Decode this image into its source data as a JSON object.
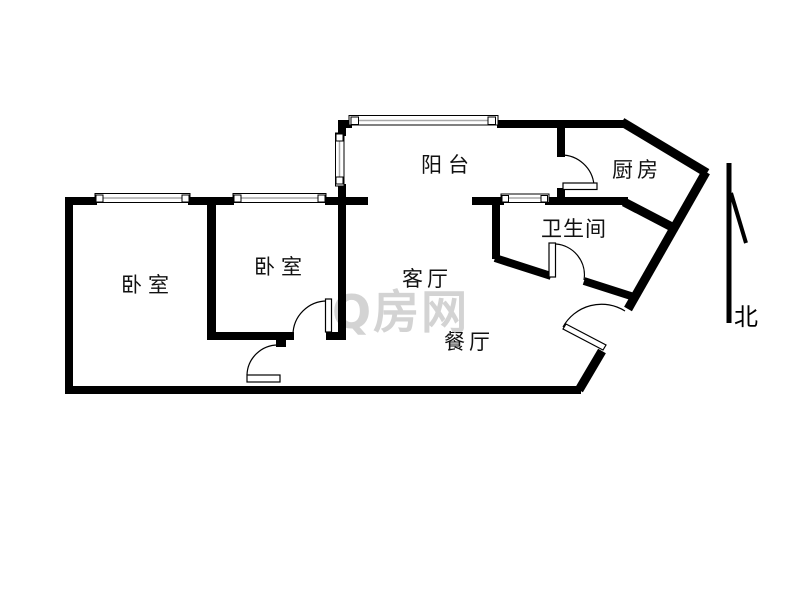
{
  "page": {
    "type": "floor-plan"
  },
  "rooms": {
    "balcony": {
      "label": "阳台"
    },
    "kitchen": {
      "label": "厨房"
    },
    "bathroom": {
      "label": "卫生间"
    },
    "bedroom1": {
      "label": "卧室"
    },
    "bedroom2": {
      "label": "卧室"
    },
    "living": {
      "label": "客厅"
    },
    "dining": {
      "label": "餐厅"
    }
  },
  "compass": {
    "label": "北"
  },
  "watermark": {
    "text": "Q房网"
  },
  "colors": {
    "wall": "#000000",
    "background": "#ffffff",
    "watermark": "#d3d3d3",
    "window_mid": "#a9a9a9"
  }
}
